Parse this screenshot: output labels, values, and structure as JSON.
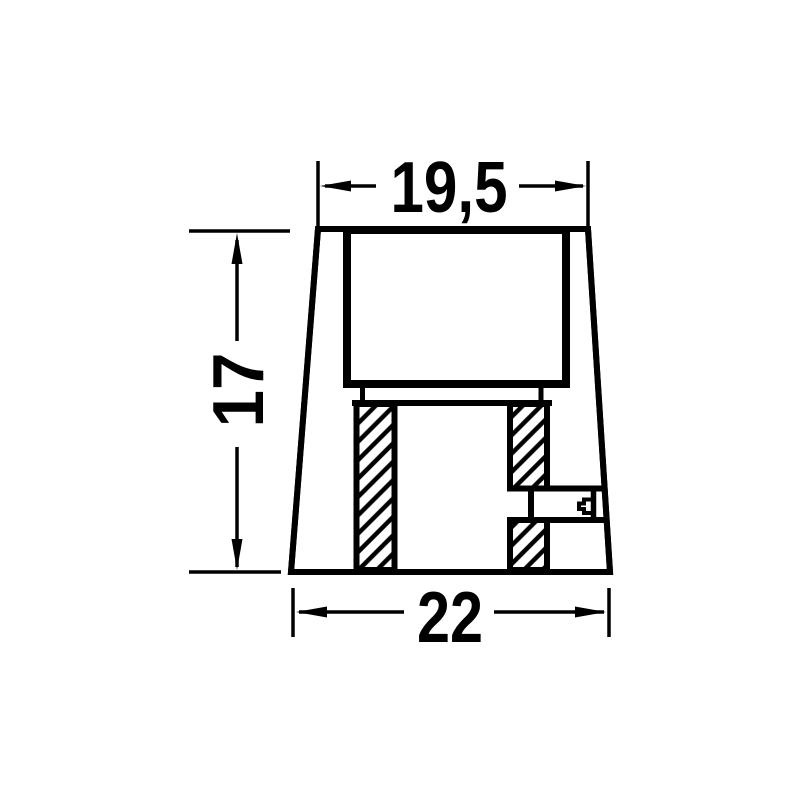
{
  "drawing": {
    "kind": "technical-drawing-cross-section",
    "dimensions": {
      "top_width": {
        "label": "19,5"
      },
      "height": {
        "label": "17"
      },
      "bottom_width": {
        "label": "22"
      }
    },
    "colors": {
      "line": "#000000",
      "background": "#ffffff"
    }
  }
}
